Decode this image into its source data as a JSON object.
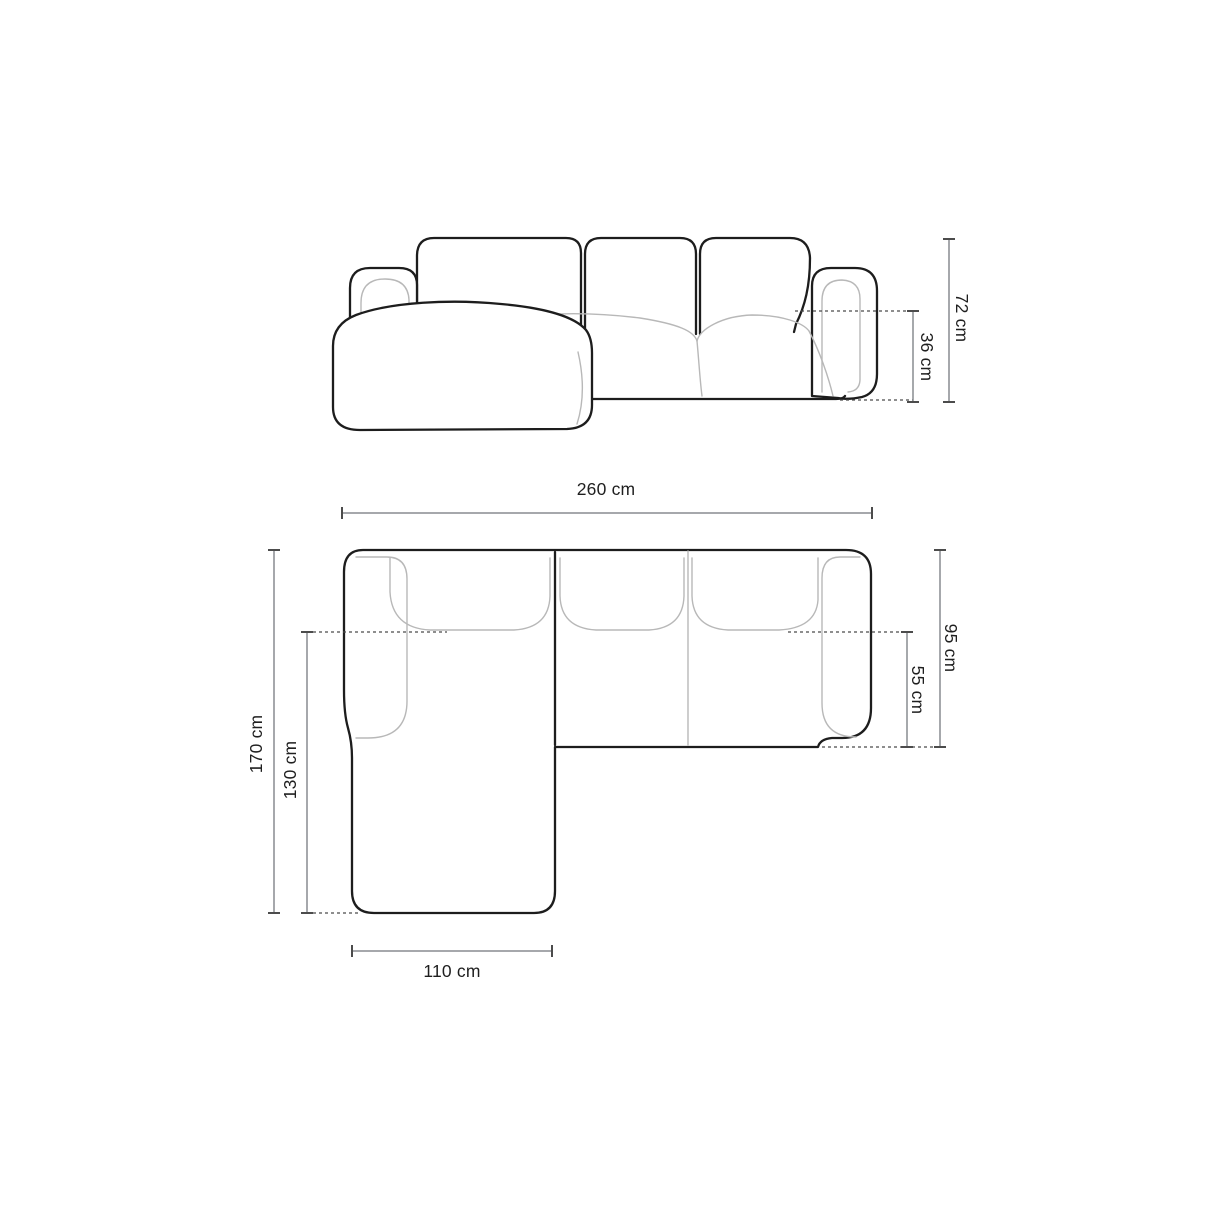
{
  "diagram": {
    "elevation": {
      "total_height": "72 cm",
      "seat_height": "36 cm"
    },
    "plan": {
      "total_width": "260 cm",
      "total_depth": "170 cm",
      "chaise_length": "130 cm",
      "body_depth": "95 cm",
      "seat_depth": "55 cm",
      "chaise_width": "110 cm"
    }
  }
}
